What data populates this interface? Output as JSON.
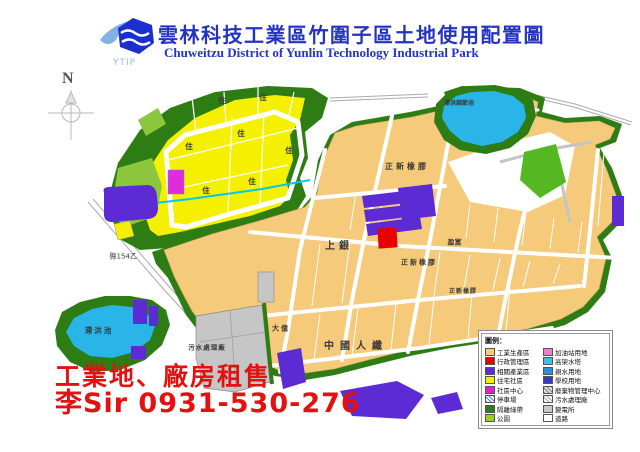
{
  "header": {
    "logo_text": "YTIP",
    "title": "雲林科技工業區竹圍子區土地使用配置圖",
    "subtitle": "Chuweitzu District of Yunlin Technology Industrial Park",
    "title_color": "#2433c0"
  },
  "compass": {
    "north_label": "N"
  },
  "map": {
    "labels": {
      "county_road": "縣154乙",
      "pond_sw": "滯洪池",
      "pond_ne": "滯洪調節池",
      "sewage_plant": "污水處理廠",
      "cheng_shin_1": "正新橡膠",
      "cheng_shin_2": "正新橡膠",
      "cheng_shin_3": "正新橡膠",
      "hiwin": "上銀",
      "ying_fu": "盈富",
      "china_manmade_fiber": "中國人纖",
      "ta_yih": "大億",
      "residential_char": "住"
    }
  },
  "legend": {
    "title": "圖例：",
    "items_left": [
      {
        "label": "工業生產區",
        "color": "#f6ca7b"
      },
      {
        "label": "行政管理區",
        "color": "#e60000"
      },
      {
        "label": "相關產業區",
        "color": "#5c2bd4"
      },
      {
        "label": "住宅社區",
        "color": "#f4f000"
      },
      {
        "label": "社區中心",
        "color": "#dd22cc"
      },
      {
        "label": "停車場",
        "color": "#ffffff",
        "pattern": "hatch",
        "hatch_color": "#5577cc"
      },
      {
        "label": "隔離綠帶",
        "color": "#2e7d14"
      },
      {
        "label": "公園",
        "color": "#9acd32"
      }
    ],
    "items_right": [
      {
        "label": "加油站用地",
        "color": "#e87fd0"
      },
      {
        "label": "高架水塔",
        "color": "#35c2e8"
      },
      {
        "label": "親水用地",
        "color": "#2f8fd6"
      },
      {
        "label": "學校用地",
        "color": "#3a3ac0"
      },
      {
        "label": "廢棄物管理中心",
        "color": "#e0e0e0",
        "pattern": "hatch",
        "hatch_color": "#888888"
      },
      {
        "label": "污水處理廠",
        "color": "#ffffff",
        "pattern": "hatch",
        "hatch_color": "#aaaaaa"
      },
      {
        "label": "變電所",
        "color": "#c8c8c8"
      },
      {
        "label": "道路",
        "color": "#ffffff"
      }
    ]
  },
  "ad": {
    "line1": "工業地、廠房租售",
    "line2": "李Sir 0931-530-276",
    "color": "#e41111"
  }
}
